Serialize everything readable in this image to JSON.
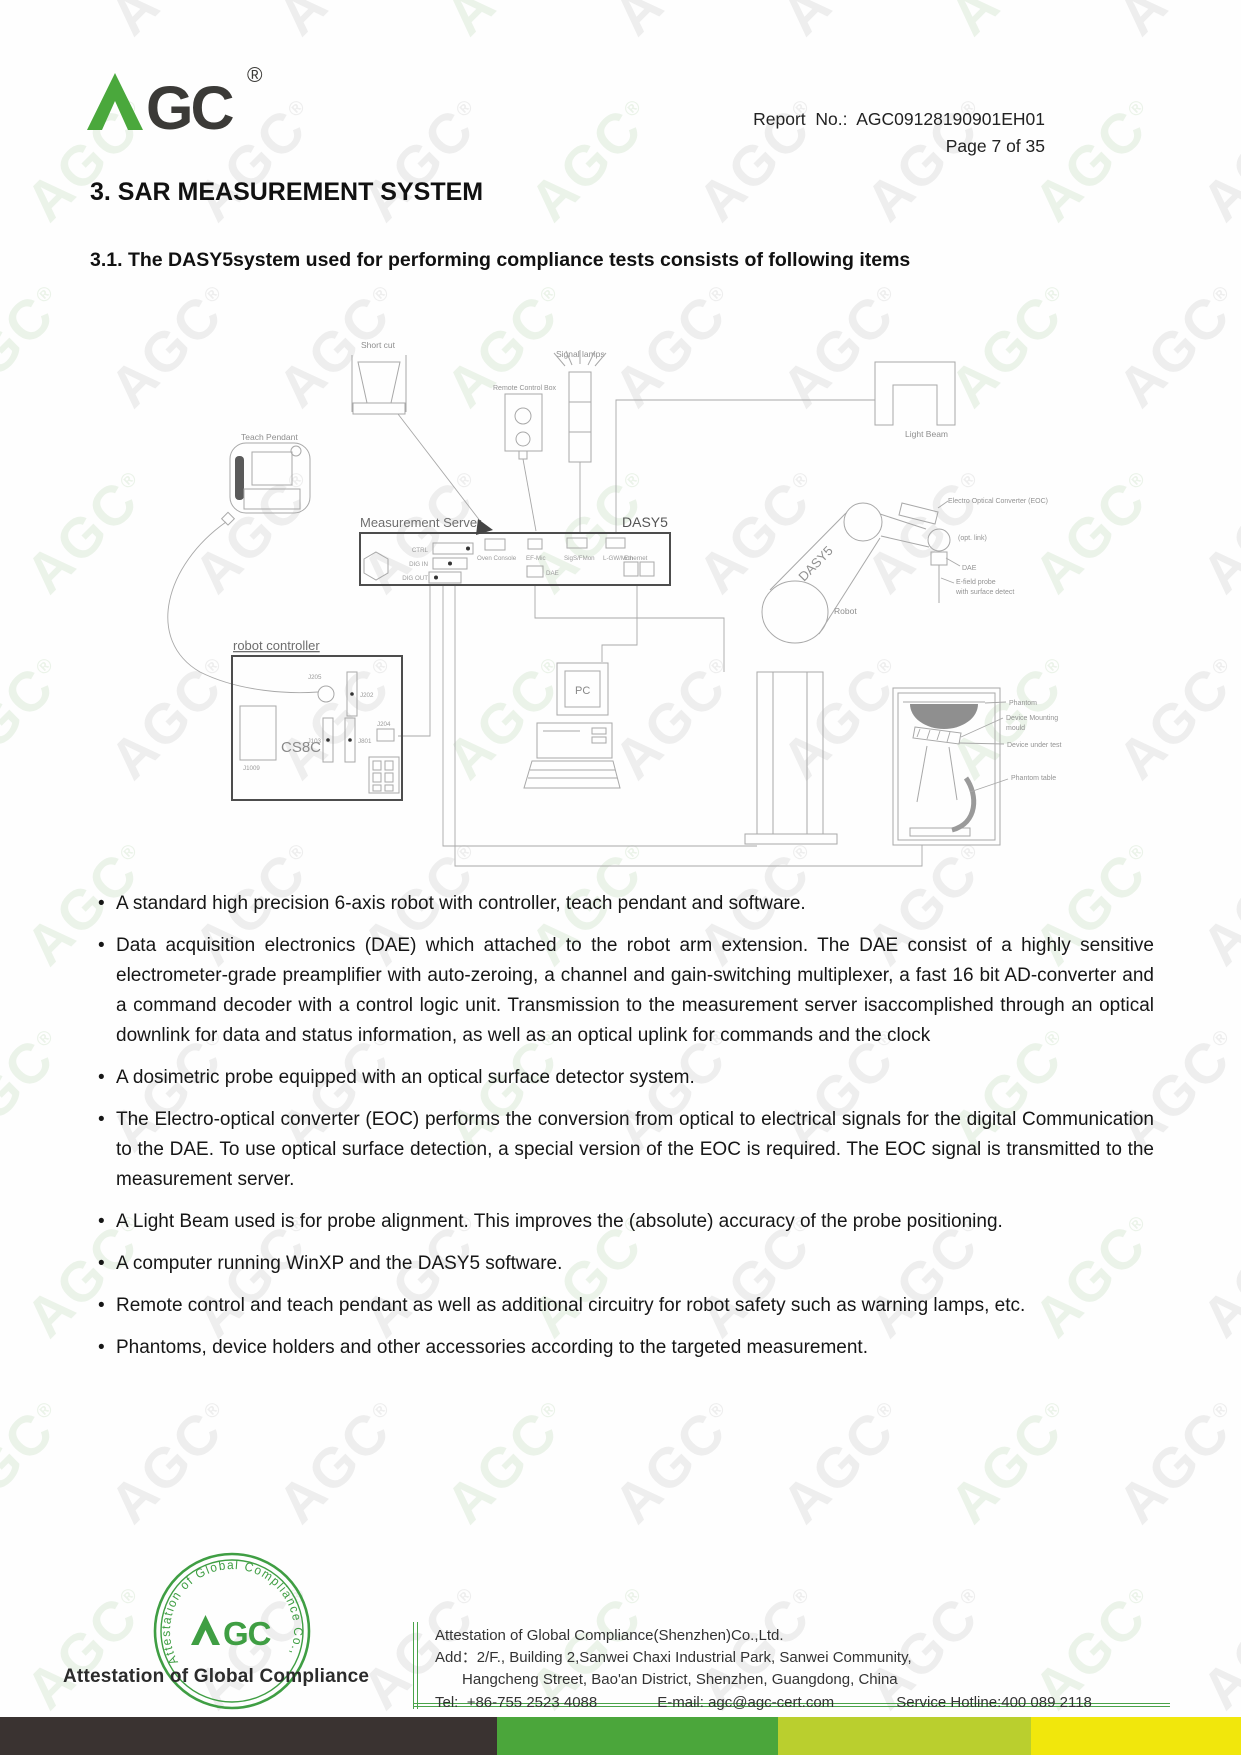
{
  "watermark": {
    "text": "AGC",
    "registered": "®"
  },
  "header": {
    "logo": {
      "brand": "AGC",
      "letters_gc": "GC",
      "registered": "®"
    },
    "report_label": "Report  No.:  AGC09128190901EH01",
    "page_label": "Page 7 of 35"
  },
  "section": {
    "title": "3. SAR MEASUREMENT SYSTEM",
    "subtitle": "3.1. The DASY5system used for performing compliance tests consists of following items"
  },
  "diagram": {
    "teach_pendant": "Teach Pendant",
    "short_cut": "Short cut",
    "remote_control_box": "Remote Control Box",
    "signal_lamps": "Signal lamps",
    "light_beam": "Light Beam",
    "measurement_server": "Measurement Server",
    "dasy5": "DASY5",
    "arm_text": "DASY5",
    "robot": "Robot",
    "robot_controller": "robot controller",
    "cs8c": "CS8C",
    "pc": "PC",
    "eoc": "Electro Optical Converter (EOC)",
    "opt_link": "(opt. link)",
    "dae_arm": "DAE",
    "probe1": "E-field probe",
    "probe2": "with surface detect",
    "phantom": "Phantom",
    "mounting1": "Device Mounting",
    "mounting2": "mould",
    "dut": "Device under test",
    "phantom_table": "Phantom table",
    "ports": {
      "ctrl": "CTRL",
      "dig_in": "DIG IN",
      "dig_out": "DIG OUT",
      "oven_console": "Oven Console",
      "ef_mic": "EF-Mic",
      "sig_mon": "SigS/FMon",
      "lgw_mon": "L-GW/Mon",
      "dae": "DAE",
      "ethernet": "Ethernet"
    },
    "connectors": {
      "j205": "J205",
      "j202": "J202",
      "j103": "J103",
      "j801": "J801",
      "j204": "J204",
      "j1009": "J1009"
    }
  },
  "bullets": [
    "A standard high precision 6-axis robot with controller, teach pendant and software.",
    "Data acquisition electronics (DAE) which attached to the robot arm extension. The DAE consist of a highly sensitive electrometer-grade preamplifier with auto-zeroing, a channel and gain-switching multiplexer, a fast 16 bit AD-converter and a command decoder with a control logic unit. Transmission to the measurement server isaccomplished through an optical downlink for data and status information, as well as an optical uplink for commands and the clock",
    "A dosimetric probe equipped with an optical surface detector system.",
    "The Electro-optical converter (EOC) performs the conversion from optical to electrical signals for the digital Communication to the DAE. To use optical surface detection, a special version of the EOC is required. The EOC signal is transmitted to the measurement server.",
    "A Light Beam used is for probe alignment. This improves the (absolute) accuracy of the probe positioning.",
    "A computer running WinXP and the DASY5 software.",
    "Remote control and teach pendant as well as additional circuitry for robot safety such as warning lamps, etc.",
    "Phantoms, device holders and other accessories according to the targeted measurement."
  ],
  "footer": {
    "stamp": {
      "ring_text": "Attestation of Global Compliance Co., Ltd",
      "letters_gc": "GC"
    },
    "attestation": "Attestation of Global Compliance",
    "company": "Attestation of Global Compliance(Shenzhen)Co.,Ltd.",
    "add_label": "Add：",
    "address1": "2/F., Building 2,Sanwei Chaxi Industrial Park, Sanwei Community,",
    "address2": "Hangcheng Street, Bao'an District, Shenzhen, Guangdong, China",
    "tel_label": "Tel:",
    "tel": "+86-755 2523 4088",
    "email_label": "E-mail:",
    "email": "agc@agc-cert.com",
    "hotline": "Service Hotline:400 089 2118"
  },
  "colors": {
    "logo_green": "#4aa83c",
    "logo_dark": "#3b3a37",
    "stamp_green": "#3f9e43",
    "bar_dark": "#3a3331",
    "bar_green": "#4ba63b",
    "bar_lime": "#bacf2e",
    "bar_yellow": "#f1e70c"
  }
}
